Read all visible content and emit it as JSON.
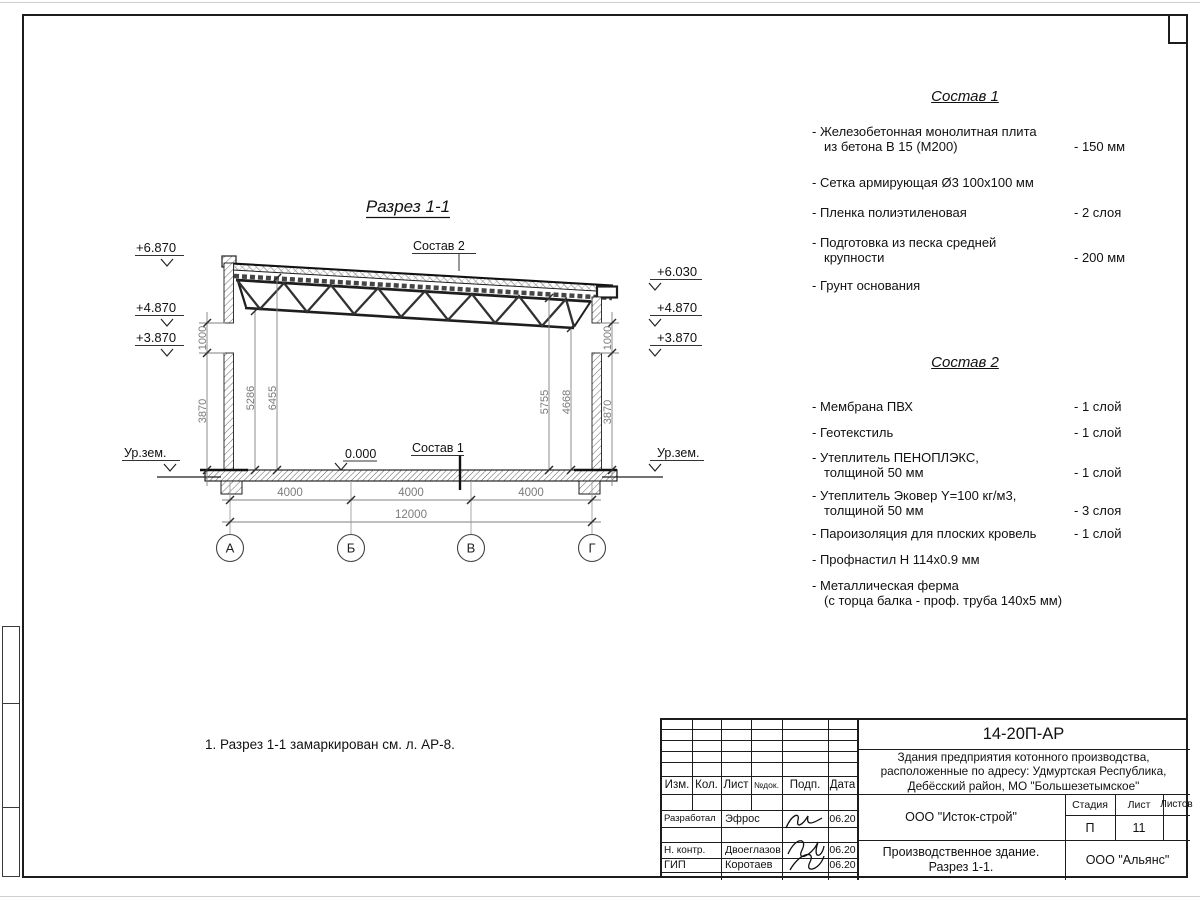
{
  "drawing": {
    "title": "Разрез 1-1",
    "callout_top": "Состав 2",
    "callout_floor": "Состав 1",
    "zero_level": "0.000",
    "ground_label_left": "Ур.зем.",
    "ground_label_right": "Ур.зем.",
    "levels_left": [
      "+6.870",
      "+4.870",
      "+3.870"
    ],
    "levels_right": [
      "+6.030",
      "+4.870",
      "+3.870"
    ],
    "axis_labels": [
      "А",
      "Б",
      "В",
      "Г"
    ],
    "dims_bottom": [
      "4000",
      "4000",
      "4000"
    ],
    "dim_total": "12000",
    "dims_left_outer": [
      "1000",
      "3870"
    ],
    "dims_left_inner": [
      "5286",
      "6455"
    ],
    "dims_right_inner": [
      "5755",
      "4668"
    ],
    "dims_right_outer": [
      "1000",
      "3870"
    ]
  },
  "note": "1. Разрез 1-1 замаркирован см. л. АР-8.",
  "sostav1": {
    "title": "Состав 1",
    "items": [
      {
        "name": "- Железобетонная  монолитная плита\nиз бетона В 15 (М200)",
        "value": "- 150 мм"
      },
      {
        "name": "- Сетка армирующая Ø3 100х100 мм",
        "value": ""
      },
      {
        "name": "- Пленка полиэтиленовая",
        "value": "-  2 слоя"
      },
      {
        "name": "- Подготовка из песка средней\nкрупности",
        "value": "- 200 мм"
      },
      {
        "name": "- Грунт основания",
        "value": ""
      }
    ]
  },
  "sostav2": {
    "title": "Состав 2",
    "items": [
      {
        "name": "- Мембрана ПВХ",
        "value": "- 1 слой"
      },
      {
        "name": "- Геотекстиль",
        "value": "- 1 слой"
      },
      {
        "name": "- Утеплитель ПЕНОПЛЭКС,\nтолщиной 50 мм",
        "value": "- 1 слой"
      },
      {
        "name": "- Утеплитель Эковер Y=100 кг/м3,\nтолщиной 50 мм",
        "value": "- 3 слоя"
      },
      {
        "name": "- Пароизоляция для плоских кровель",
        "value": "- 1 слой"
      },
      {
        "name": "- Профнастил Н 114х0.9 мм",
        "value": ""
      },
      {
        "name": "- Металлическая ферма\n(с торца балка - проф. труба 140х5 мм)",
        "value": ""
      }
    ]
  },
  "titleblock": {
    "doc_number": "14-20П-АР",
    "project": "Здания предприятия котонного производства,\nрасположенные по адресу: Удмуртская Республика,\nДебёсский район, МО \"Большезетымское\"",
    "columns": [
      "Изм.",
      "Кол.",
      "Лист",
      "№док.",
      "Подп.",
      "Дата"
    ],
    "rows": [
      {
        "role": "Разработал",
        "name": "Эфрос",
        "date": "06.20"
      },
      {
        "role": "Н. контр.",
        "name": "Двоеглазов",
        "date": "06.20"
      },
      {
        "role": "ГИП",
        "name": "Коротаев",
        "date": "06.20"
      }
    ],
    "org": "ООО \"Исток-строй\"",
    "stage_label": "Стадия",
    "sheet_label": "Лист",
    "sheets_label": "Листов",
    "stage": "П",
    "sheet": "11",
    "sheets": "",
    "object": "Производственное здание.\nРазрез 1-1.",
    "contractor": "ООО \"Альянс\""
  }
}
